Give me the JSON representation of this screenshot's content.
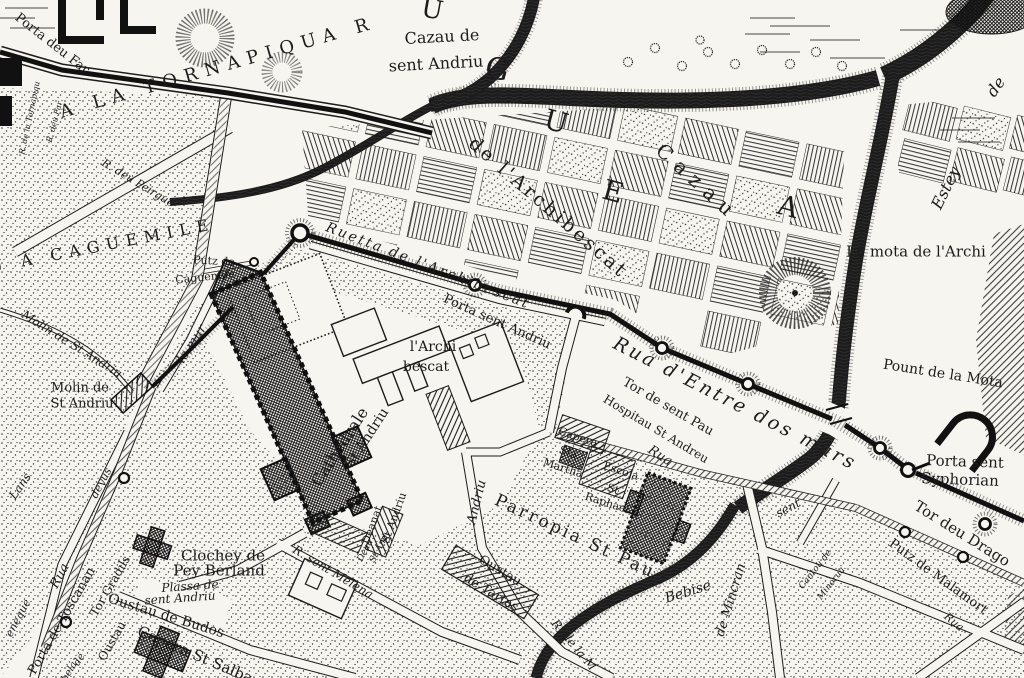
{
  "colors": {
    "ink": "#1c1c1c",
    "paper": "#f7f5ef"
  },
  "labels": [
    {
      "t": "Porta deu Far"
    },
    {
      "t": "R. de la Tornapiqu"
    },
    {
      "t": "R. deu Far"
    },
    {
      "t": "A LA TORNAPIQUA R"
    },
    {
      "t": "Cazau de"
    },
    {
      "t": "sent Andriu"
    },
    {
      "t": "U"
    },
    {
      "t": "G"
    },
    {
      "t": "U"
    },
    {
      "t": "E"
    },
    {
      "t": "A"
    },
    {
      "t": "Cazau"
    },
    {
      "t": "de l'Archibescat"
    },
    {
      "t": "Estey"
    },
    {
      "t": "de"
    },
    {
      "t": "La mota de l'Archi"
    },
    {
      "t": "Ruetta de l'Archibescat"
    },
    {
      "t": "Porta sent Andriu"
    },
    {
      "t": "Rua d'Entre dos murs"
    },
    {
      "t": "Tor de sent Pau"
    },
    {
      "t": "Hospitau St Andreu"
    },
    {
      "t": "Rua"
    },
    {
      "t": "Pount de la Mota"
    },
    {
      "t": "Porta sent"
    },
    {
      "t": "Syphorian"
    },
    {
      "t": "Tor deu Drago"
    },
    {
      "t": "Putz de Malamort"
    },
    {
      "t": "Rua"
    },
    {
      "t": "Cantou de"
    },
    {
      "t": "Minorua"
    },
    {
      "t": "U À CAGUEMILE"
    },
    {
      "t": "Putz de"
    },
    {
      "t": "Caguemile"
    },
    {
      "t": "Molin de St Andriu"
    },
    {
      "t": "Molin de"
    },
    {
      "t": "St Andriu"
    },
    {
      "t": "le mur"
    },
    {
      "t": "l'Archi"
    },
    {
      "t": "bescat"
    },
    {
      "t": "Cathedrale"
    },
    {
      "t": "St Andriu"
    },
    {
      "t": "Deanat"
    },
    {
      "t": "St Andriu"
    },
    {
      "t": "Andriu"
    },
    {
      "t": "Capera"
    },
    {
      "t": "Sta."
    },
    {
      "t": "Martha"
    },
    {
      "t": "Escola"
    },
    {
      "t": "St"
    },
    {
      "t": "Raphael"
    },
    {
      "t": "Parropia St Pau"
    },
    {
      "t": "Oustau"
    },
    {
      "t": "de Tartas"
    },
    {
      "t": "Bebise"
    },
    {
      "t": "R. de la M"
    },
    {
      "t": "de Mincran"
    },
    {
      "t": "sent"
    },
    {
      "t": "Clochey de"
    },
    {
      "t": "Pey Berland"
    },
    {
      "t": "Plassa de"
    },
    {
      "t": "sent Andriu"
    },
    {
      "t": "Oustau de Budos"
    },
    {
      "t": "Capera St Salba"
    },
    {
      "t": "R. sent Melena"
    },
    {
      "t": "Deau"
    },
    {
      "t": "St And"
    },
    {
      "t": "Lans"
    },
    {
      "t": "deyus"
    },
    {
      "t": "Rua"
    },
    {
      "t": "eneque"
    },
    {
      "t": "Porta de Toscanan"
    },
    {
      "t": "Tor Gradils"
    },
    {
      "t": "Oustau"
    },
    {
      "t": "de"
    },
    {
      "t": "bela"
    },
    {
      "t": "R. deu Peirgue"
    }
  ]
}
